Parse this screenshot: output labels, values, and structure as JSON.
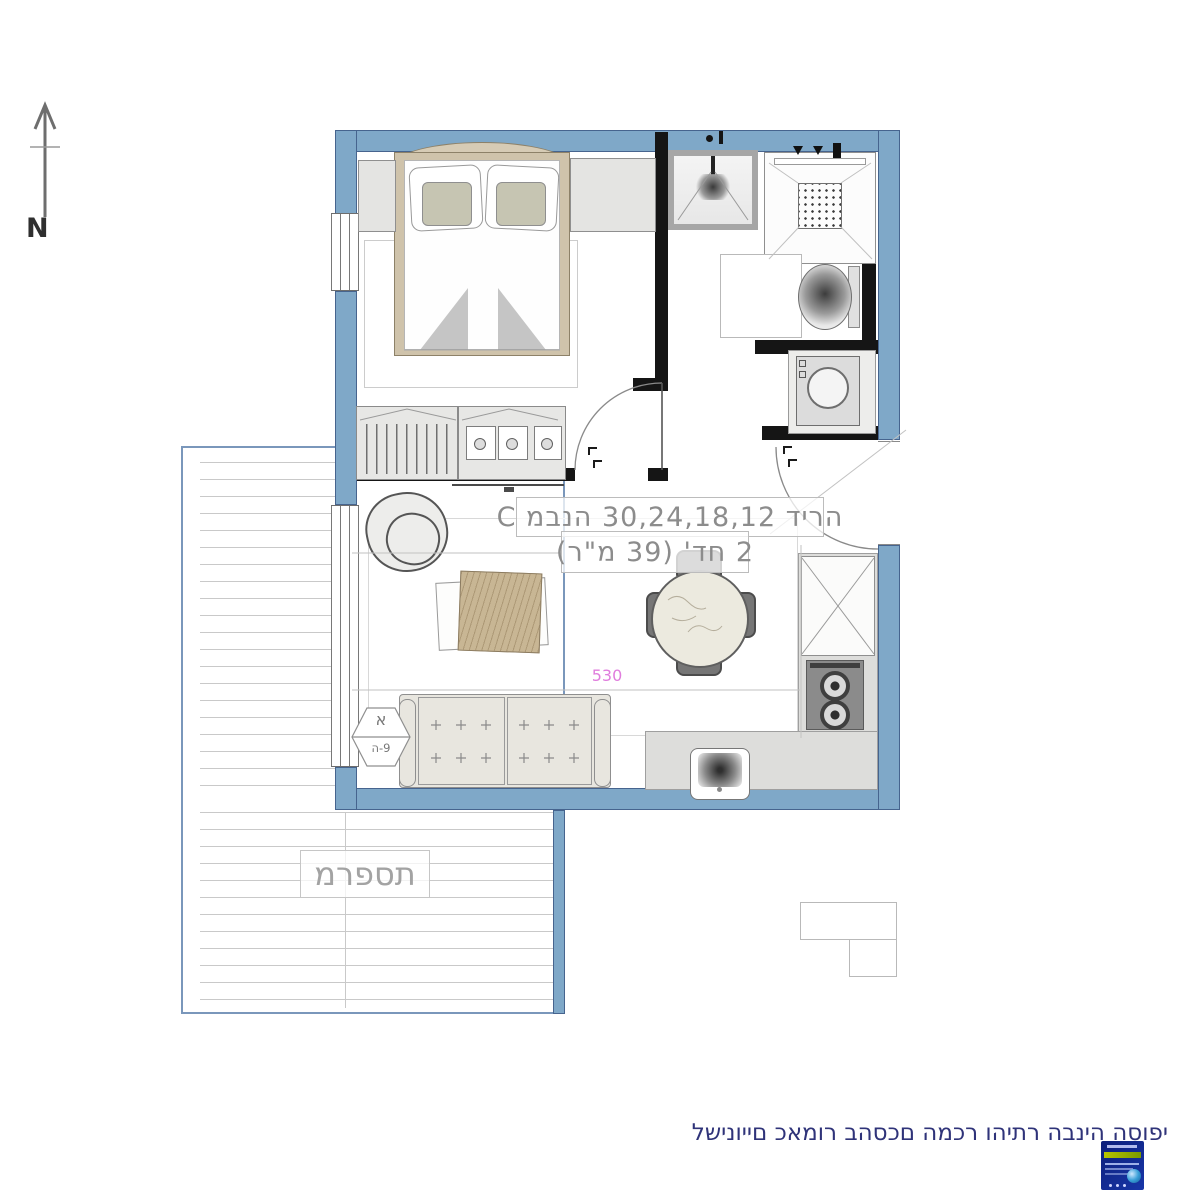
{
  "compass": {
    "label": "N"
  },
  "unit_label": {
    "line1": "C מבנה  30,24,18,12 דירה",
    "line2": "2 חד' (39 מ\"ר)"
  },
  "balcony": {
    "label": "מרפסת"
  },
  "dimensions": {
    "width_530": "530"
  },
  "section_marker": {
    "top": "א",
    "bottom": "ה-9"
  },
  "footer": {
    "disclaimer": "לשינויים כאמור בהסכם המכר והיתר הבניה הסופי"
  },
  "colors": {
    "wall_blue": "#7fa8c8",
    "wall_edge": "#46648e",
    "interior_wall_black": "#151515",
    "label_gray": "#8c8c8c",
    "dimension_pink": "#e07ddd",
    "footer_navy": "#2f3379",
    "deck_line_gray": "#c9c9c9"
  }
}
